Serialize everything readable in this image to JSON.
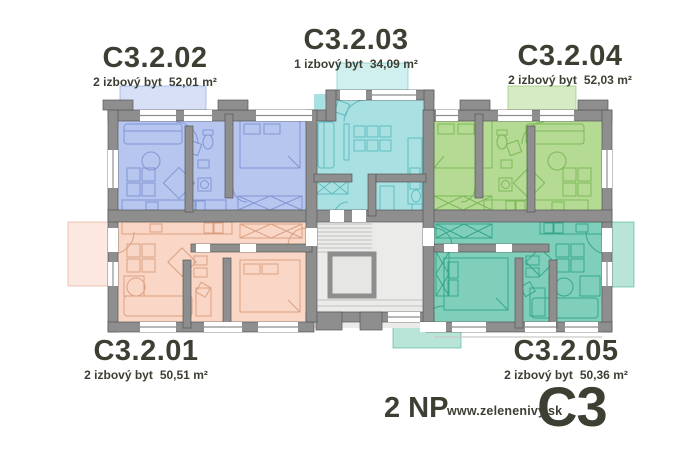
{
  "apartments": [
    {
      "label": "C3.2.01",
      "type": "2 izbový byt",
      "area": "50,51 m²"
    },
    {
      "label": "C3.2.02",
      "type": "2 izbový byt",
      "area": "52,01 m²"
    },
    {
      "label": "C3.2.03",
      "type": "1 izbový byt",
      "area": "34,09 m²"
    },
    {
      "label": "C3.2.04",
      "type": "2 izbový byt",
      "area": "52,03 m²"
    },
    {
      "label": "C3.2.05",
      "type": "2 izbový byt",
      "area": "50,36 m²"
    }
  ],
  "footer": {
    "floor": "2 NP",
    "website": "www.zelenenivy.sk",
    "building": "C3"
  },
  "colors": {
    "apt01": "#f9d6c6",
    "apt01-line": "#dca183",
    "apt02": "#b7c6ee",
    "apt02-line": "#8296d4",
    "apt03": "#a9e1e2",
    "apt03-line": "#5fbdc0",
    "apt04": "#b4da93",
    "apt04-line": "#7eb958",
    "apt05": "#80cfba",
    "apt05-line": "#37a78c",
    "wall": "#8e8e8e",
    "wall-edge": "#575757",
    "core": "#ebebe9",
    "core-line": "#c9c9c7",
    "text": "#3c4033",
    "background": "#ffffff"
  }
}
